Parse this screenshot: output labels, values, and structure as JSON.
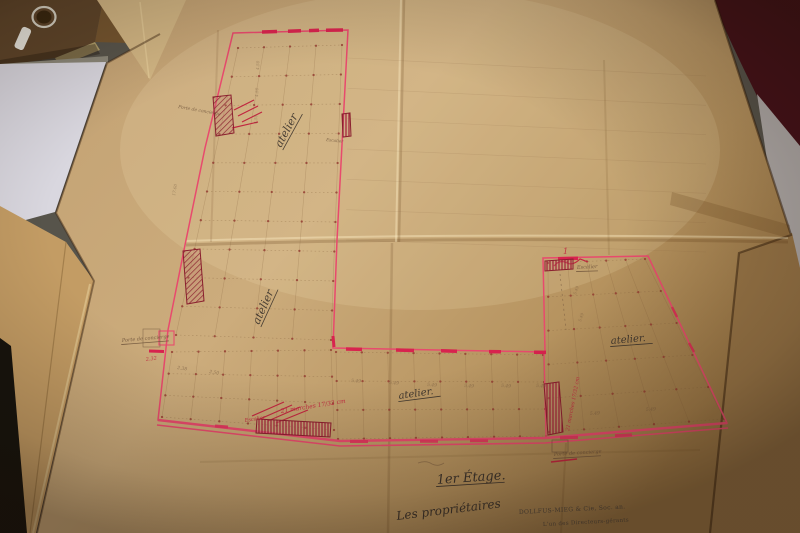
{
  "document": {
    "type": "archival floor plan photograph",
    "floor_title": "1er Étage.",
    "signature_intro": "Les propriétaires",
    "stamp_company": "DOLLFUS-MIEG & Cie, Soc. an.",
    "stamp_role": "L'un des Directeurs-gérants"
  },
  "palette": {
    "ink": "#3b332c",
    "pencil": "#6d523a",
    "red": "#c1263f",
    "stamp": "#4c443c",
    "plan_pink": "#e84a6d",
    "window_red": "#d8234e",
    "stair_dark_red": "#8a1f2e",
    "sheet_tan": "#c9a878",
    "table_gray": "#57544b",
    "maroon": "#451119",
    "white_paper": "#d9d7df"
  },
  "plan": {
    "grids": [
      {
        "corners": [
          [
            238,
            48
          ],
          [
            342,
            45
          ],
          [
            331,
            340
          ],
          [
            176,
            335
          ]
        ],
        "cols": 4,
        "rows": 10,
        "faint": false
      },
      {
        "corners": [
          [
            172,
            352
          ],
          [
            331,
            350
          ],
          [
            334,
            430
          ],
          [
            162,
            417
          ]
        ],
        "cols": 6,
        "rows": 3,
        "faint": false
      },
      {
        "corners": [
          [
            336,
            352
          ],
          [
            543,
            355
          ],
          [
            546,
            436
          ],
          [
            338,
            439
          ]
        ],
        "cols": 8,
        "rows": 3,
        "faint": false
      },
      {
        "corners": [
          [
            548,
            263
          ],
          [
            645,
            259
          ],
          [
            724,
            419
          ],
          [
            549,
            432
          ]
        ],
        "cols": 5,
        "rows": 5,
        "faint": false
      },
      {
        "corners": [
          [
            348,
            58
          ],
          [
            706,
            76
          ],
          [
            706,
            252
          ],
          [
            346,
            240
          ]
        ],
        "cols": 1,
        "rows": 6,
        "faint": true
      }
    ],
    "annotations": [
      {
        "text": "atelier",
        "x": 281,
        "y": 148,
        "size": 11,
        "rot": -62,
        "color": "ink",
        "underline": true,
        "opacity": 0.9
      },
      {
        "text": "atelier",
        "x": 259,
        "y": 325,
        "size": 11,
        "rot": -66,
        "color": "ink",
        "underline": true,
        "opacity": 0.9
      },
      {
        "text": "atelier.",
        "x": 399,
        "y": 399,
        "size": 10,
        "rot": -8,
        "color": "ink",
        "underline": true,
        "opacity": 0.95
      },
      {
        "text": "atelier.",
        "x": 611,
        "y": 344,
        "size": 10,
        "rot": -5,
        "color": "ink",
        "underline": true,
        "opacity": 0.95
      },
      {
        "text": "1er Étage.",
        "x": 437,
        "y": 484,
        "size": 13,
        "rot": -4,
        "color": "ink",
        "underline": true,
        "opacity": 1
      },
      {
        "text": "Les propriétaires",
        "x": 397,
        "y": 520,
        "size": 12,
        "rot": -7,
        "color": "ink",
        "underline": false,
        "opacity": 1
      },
      {
        "text": "DOLLFUS-MIEG & Cie, Soc. an.",
        "x": 519,
        "y": 514,
        "size": 6,
        "rot": -3,
        "color": "stamp",
        "underline": false,
        "opacity": 0.95
      },
      {
        "text": "L'un des Directeurs-gérants",
        "x": 543,
        "y": 526,
        "size": 5.5,
        "rot": -3,
        "color": "stamp",
        "underline": false,
        "opacity": 0.9
      },
      {
        "text": "Porte de concierge",
        "x": 178,
        "y": 108,
        "size": 4.5,
        "rot": 10,
        "color": "pencil",
        "underline": false,
        "opacity": 0.8
      },
      {
        "text": "Porte de concierge",
        "x": 122,
        "y": 342,
        "size": 5,
        "rot": -5,
        "color": "pencil",
        "underline": true,
        "opacity": 0.85
      },
      {
        "text": "Porte de concierge",
        "x": 554,
        "y": 456,
        "size": 5,
        "rot": -4,
        "color": "pencil",
        "underline": true,
        "opacity": 0.85
      },
      {
        "text": "Escalier",
        "x": 326,
        "y": 141,
        "size": 4.2,
        "rot": 6,
        "color": "pencil",
        "underline": false,
        "opacity": 0.8
      },
      {
        "text": "Escalier",
        "x": 577,
        "y": 269,
        "size": 5,
        "rot": -3,
        "color": "pencil",
        "underline": true,
        "opacity": 0.85
      },
      {
        "text": "5.49",
        "x": 351,
        "y": 382,
        "size": 4.5,
        "rot": 3,
        "color": "pencil",
        "underline": false,
        "opacity": 0.55
      },
      {
        "text": "5.49",
        "x": 389,
        "y": 384,
        "size": 4.5,
        "rot": 3,
        "color": "pencil",
        "underline": false,
        "opacity": 0.55
      },
      {
        "text": "5.49",
        "x": 427,
        "y": 386,
        "size": 4.5,
        "rot": 3,
        "color": "pencil",
        "underline": false,
        "opacity": 0.55
      },
      {
        "text": "5.49",
        "x": 464,
        "y": 387,
        "size": 4.5,
        "rot": 3,
        "color": "pencil",
        "underline": false,
        "opacity": 0.55
      },
      {
        "text": "5.49",
        "x": 501,
        "y": 387,
        "size": 4.5,
        "rot": 3,
        "color": "pencil",
        "underline": false,
        "opacity": 0.55
      },
      {
        "text": "5.49",
        "x": 536,
        "y": 387,
        "size": 4.5,
        "rot": 3,
        "color": "pencil",
        "underline": false,
        "opacity": 0.55
      },
      {
        "text": "2.38",
        "x": 177,
        "y": 369,
        "size": 4.5,
        "rot": 8,
        "color": "pencil",
        "underline": false,
        "opacity": 0.6
      },
      {
        "text": "2.50",
        "x": 209,
        "y": 373,
        "size": 4.5,
        "rot": 8,
        "color": "pencil",
        "underline": false,
        "opacity": 0.6
      },
      {
        "text": "5.49",
        "x": 590,
        "y": 415,
        "size": 4.5,
        "rot": -4,
        "color": "pencil",
        "underline": false,
        "opacity": 0.55
      },
      {
        "text": "5.49",
        "x": 646,
        "y": 411,
        "size": 4.5,
        "rot": -4,
        "color": "pencil",
        "underline": false,
        "opacity": 0.55
      },
      {
        "text": "4.50",
        "x": 259,
        "y": 70,
        "size": 4.2,
        "rot": -88,
        "color": "pencil",
        "underline": false,
        "opacity": 0.5
      },
      {
        "text": "4.50",
        "x": 258,
        "y": 97,
        "size": 4.2,
        "rot": -88,
        "color": "pencil",
        "underline": false,
        "opacity": 0.5
      },
      {
        "text": "4.50",
        "x": 257,
        "y": 124,
        "size": 4.2,
        "rot": -88,
        "color": "pencil",
        "underline": false,
        "opacity": 0.5
      },
      {
        "text": "17.60",
        "x": 175,
        "y": 196,
        "size": 4.2,
        "rot": -80,
        "color": "pencil",
        "underline": false,
        "opacity": 0.5
      },
      {
        "text": "5.49",
        "x": 576,
        "y": 295,
        "size": 4,
        "rot": -72,
        "color": "pencil",
        "underline": false,
        "opacity": 0.5
      },
      {
        "text": "5.49",
        "x": 581,
        "y": 322,
        "size": 4,
        "rot": -72,
        "color": "pencil",
        "underline": false,
        "opacity": 0.5
      },
      {
        "text": "Escalier",
        "x": 245,
        "y": 422,
        "size": 5,
        "rot": -9,
        "color": "red",
        "underline": false,
        "opacity": 0.95
      },
      {
        "text": "21 marches 17/32 cm",
        "x": 281,
        "y": 413,
        "size": 6,
        "rot": -9,
        "color": "red",
        "underline": false,
        "opacity": 0.95
      },
      {
        "text": "21 marches 17/32 cm",
        "x": 569,
        "y": 431,
        "size": 5,
        "rot": -79,
        "color": "red",
        "underline": false,
        "opacity": 0.95
      },
      {
        "text": "2.32",
        "x": 146,
        "y": 361,
        "size": 5,
        "rot": -8,
        "color": "red",
        "underline": false,
        "opacity": 0.9
      },
      {
        "text": "1",
        "x": 563,
        "y": 254,
        "size": 8,
        "rot": 0,
        "color": "red",
        "underline": false,
        "opacity": 0.9
      }
    ],
    "stairs": [
      {
        "pts": "213,97 231,95 234,133 216,136",
        "hatch": "d"
      },
      {
        "pts": "342,114 350,113 351,136 343,137",
        "hatch": "v"
      },
      {
        "pts": "183,251 200,249 204,301 187,304",
        "hatch": "d"
      },
      {
        "pts": "257,419 331,423 330,437 256,433",
        "hatch": "v"
      },
      {
        "pts": "545,261 573,259 573,269 545,271",
        "hatch": "v"
      },
      {
        "pts": "544,384 559,382 563,432 548,435",
        "hatch": "v"
      }
    ]
  }
}
